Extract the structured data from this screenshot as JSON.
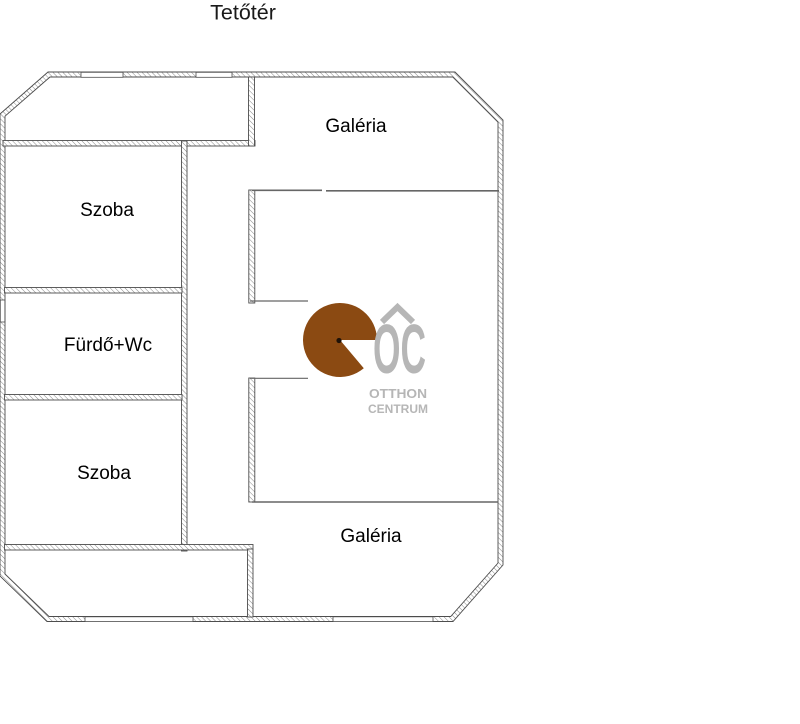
{
  "title": "Tetőtér",
  "rooms": [
    {
      "name": "galeria-upper",
      "label": "Galéria"
    },
    {
      "name": "szoba-upper",
      "label": "Szoba"
    },
    {
      "name": "furdo-wc",
      "label": "Fürdő+Wc"
    },
    {
      "name": "szoba-lower",
      "label": "Szoba"
    },
    {
      "name": "galeria-lower",
      "label": "Galéria"
    }
  ],
  "watermark": {
    "initials": "OC",
    "line1": "OTTHON",
    "line2": "CENTRUM"
  },
  "colors": {
    "background": "#FFFFFF",
    "wall_outline": "#4D4D4D",
    "hatch_line": "#8A8A8A",
    "railing": "#666666",
    "label_color": "#000000",
    "logo_brown": "#8B4A12",
    "logo_dot": "#1F1208",
    "logo_gray": "#B6B6B6"
  }
}
